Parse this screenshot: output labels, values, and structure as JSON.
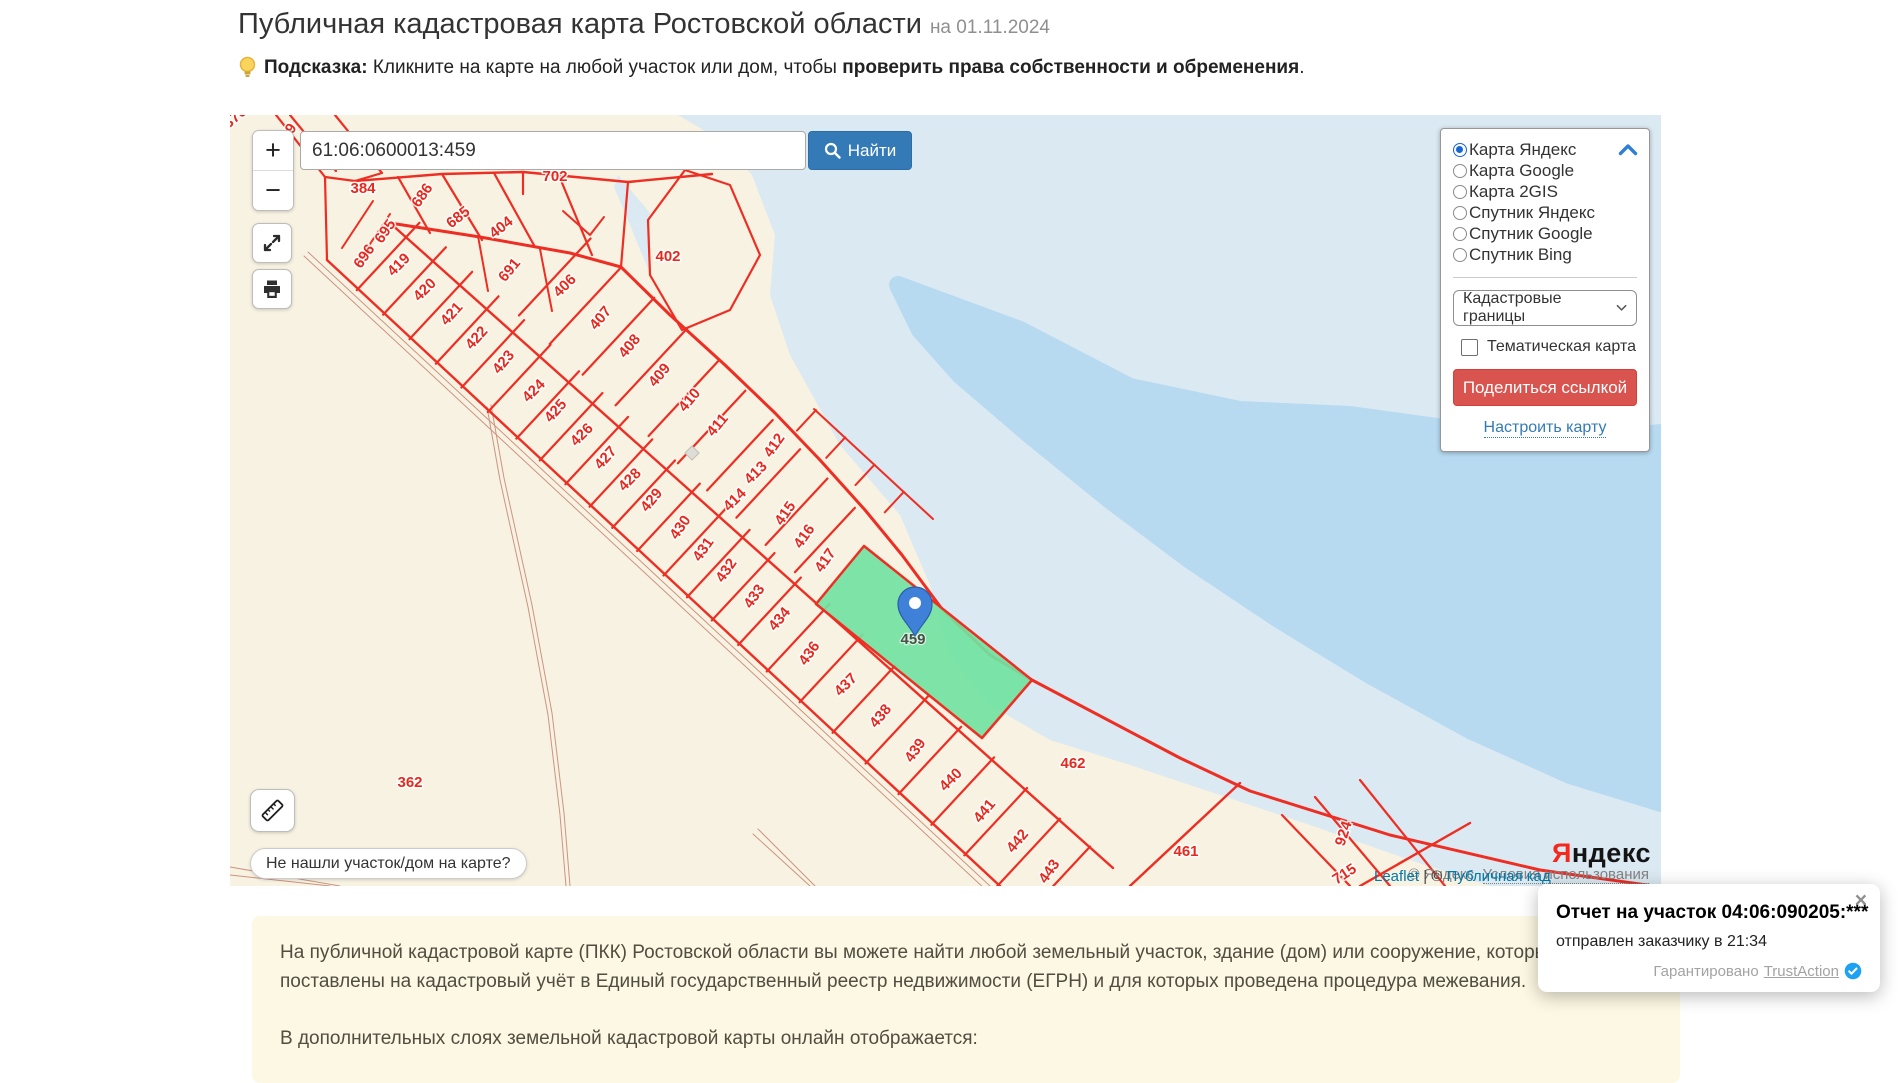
{
  "header": {
    "title": "Публичная кадастровая карта Ростовской области",
    "date": "на 01.11.2024"
  },
  "hint": {
    "label": "Подсказка:",
    "text": " Кликните на карте на любой участок или дом, чтобы ",
    "bold": "проверить права собственности и обременения",
    "period": "."
  },
  "search": {
    "value": "61:06:0600013:459",
    "button": "Найти"
  },
  "map_controls": {
    "zoom_in": "+",
    "zoom_out": "−",
    "not_found_button": "Не нашли участок/дом на карте?"
  },
  "layers_panel": {
    "options": [
      {
        "label": "Карта Яндекс",
        "selected": true
      },
      {
        "label": "Карта Google",
        "selected": false
      },
      {
        "label": "Карта 2GIS",
        "selected": false
      },
      {
        "label": "Спутник Яндекс",
        "selected": false
      },
      {
        "label": "Спутник Google",
        "selected": false
      },
      {
        "label": "Спутник Bing",
        "selected": false
      }
    ],
    "layer_select_value": "Кадастровые границы",
    "thematic_label": "Тематическая карта",
    "share_button": "Поделиться ссылкой",
    "configure_link": "Настроить карту"
  },
  "map": {
    "selected_parcel": {
      "n": "459",
      "x": 683,
      "y": 529
    },
    "labels": [
      {
        "n": "376",
        "x": 8,
        "y": 6,
        "r": -40
      },
      {
        "n": "599",
        "x": 60,
        "y": 23,
        "r": -55
      },
      {
        "n": "384",
        "x": 133,
        "y": 78,
        "r": 0
      },
      {
        "n": "686",
        "x": 196,
        "y": 83,
        "r": -55
      },
      {
        "n": "685",
        "x": 231,
        "y": 106,
        "r": -38
      },
      {
        "n": "404",
        "x": 274,
        "y": 116,
        "r": -38
      },
      {
        "n": "702",
        "x": 325,
        "y": 66,
        "r": 0
      },
      {
        "n": "691",
        "x": 283,
        "y": 158,
        "r": -50
      },
      {
        "n": "695",
        "x": 159,
        "y": 119,
        "r": -55
      },
      {
        "n": "696",
        "x": 138,
        "y": 144,
        "r": -55
      },
      {
        "n": "402",
        "x": 438,
        "y": 146,
        "r": 0
      },
      {
        "n": "419",
        "x": 172,
        "y": 153,
        "r": -45
      },
      {
        "n": "420",
        "x": 198,
        "y": 178,
        "r": -45
      },
      {
        "n": "421",
        "x": 225,
        "y": 202,
        "r": -48
      },
      {
        "n": "422",
        "x": 250,
        "y": 226,
        "r": -48
      },
      {
        "n": "423",
        "x": 277,
        "y": 250,
        "r": -50
      },
      {
        "n": "424",
        "x": 307,
        "y": 279,
        "r": -45
      },
      {
        "n": "425",
        "x": 329,
        "y": 299,
        "r": -48
      },
      {
        "n": "426",
        "x": 355,
        "y": 323,
        "r": -45
      },
      {
        "n": "427",
        "x": 379,
        "y": 346,
        "r": -48
      },
      {
        "n": "428",
        "x": 403,
        "y": 368,
        "r": -45
      },
      {
        "n": "429",
        "x": 425,
        "y": 388,
        "r": -50
      },
      {
        "n": "430",
        "x": 454,
        "y": 415,
        "r": -55
      },
      {
        "n": "431",
        "x": 477,
        "y": 437,
        "r": -55
      },
      {
        "n": "432",
        "x": 500,
        "y": 458,
        "r": -55
      },
      {
        "n": "433",
        "x": 528,
        "y": 484,
        "r": -55
      },
      {
        "n": "434",
        "x": 553,
        "y": 507,
        "r": -50
      },
      {
        "n": "406",
        "x": 338,
        "y": 174,
        "r": -45
      },
      {
        "n": "407",
        "x": 374,
        "y": 206,
        "r": -50
      },
      {
        "n": "408",
        "x": 403,
        "y": 234,
        "r": -50
      },
      {
        "n": "409",
        "x": 433,
        "y": 263,
        "r": -50
      },
      {
        "n": "410",
        "x": 463,
        "y": 288,
        "r": -50
      },
      {
        "n": "411",
        "x": 491,
        "y": 313,
        "r": -50
      },
      {
        "n": "412",
        "x": 548,
        "y": 333,
        "r": -55
      },
      {
        "n": "413",
        "x": 529,
        "y": 361,
        "r": -45
      },
      {
        "n": "414",
        "x": 508,
        "y": 388,
        "r": -45
      },
      {
        "n": "415",
        "x": 559,
        "y": 401,
        "r": -55
      },
      {
        "n": "416",
        "x": 578,
        "y": 424,
        "r": -55
      },
      {
        "n": "417",
        "x": 599,
        "y": 448,
        "r": -55
      },
      {
        "n": "436",
        "x": 583,
        "y": 541,
        "r": -55
      },
      {
        "n": "437",
        "x": 619,
        "y": 573,
        "r": -45
      },
      {
        "n": "438",
        "x": 654,
        "y": 604,
        "r": -50
      },
      {
        "n": "439",
        "x": 689,
        "y": 638,
        "r": -55
      },
      {
        "n": "440",
        "x": 724,
        "y": 668,
        "r": -45
      },
      {
        "n": "441",
        "x": 758,
        "y": 699,
        "r": -50
      },
      {
        "n": "442",
        "x": 791,
        "y": 729,
        "r": -50
      },
      {
        "n": "443",
        "x": 823,
        "y": 759,
        "r": -55
      },
      {
        "n": "462",
        "x": 843,
        "y": 653,
        "r": 0
      },
      {
        "n": "461",
        "x": 956,
        "y": 741,
        "r": 0
      },
      {
        "n": "924",
        "x": 1118,
        "y": 720,
        "r": -72
      },
      {
        "n": "715",
        "x": 1117,
        "y": 763,
        "r": -33
      },
      {
        "n": "362",
        "x": 180,
        "y": 672,
        "r": 0
      }
    ],
    "colors": {
      "land": "#f7f2e2",
      "water": "#dbe9f2",
      "water_deep": "#b7daf1",
      "parcel_line": "#ee2d23",
      "parcel_label": "#e42a1f",
      "road": "#cd9480",
      "selected_fill": "#72e2a1",
      "selected_label": "#4a4f49",
      "marker": "#3f80d8"
    }
  },
  "attribution": {
    "leaflet": "Leaflet",
    "separator": " | © ",
    "pkk": "Публичная кад",
    "yandex_copyright": "© Яндекс",
    "terms": "Условия использования",
    "logo_ya": "Я",
    "logo_rest": "ндекс"
  },
  "notification": {
    "close": "×",
    "title": "Отчет на участок 04:06:090205:***",
    "body": "отправлен заказчику в 21:34",
    "guaranteed": "Гарантировано",
    "brand": "TrustAction"
  },
  "info_box": {
    "p1": "На публичной кадастровой карте (ПКК) Ростовской области вы можете найти любой земельный участок, здание (дом) или сооружение, которые поставлены на кадастровый учёт в Единый государственный реестр недвижимости (ЕГРН) и для которых проведена процедура межевания.",
    "p2": "В дополнительных слоях земельной кадастровой карты онлайн отображается:"
  }
}
